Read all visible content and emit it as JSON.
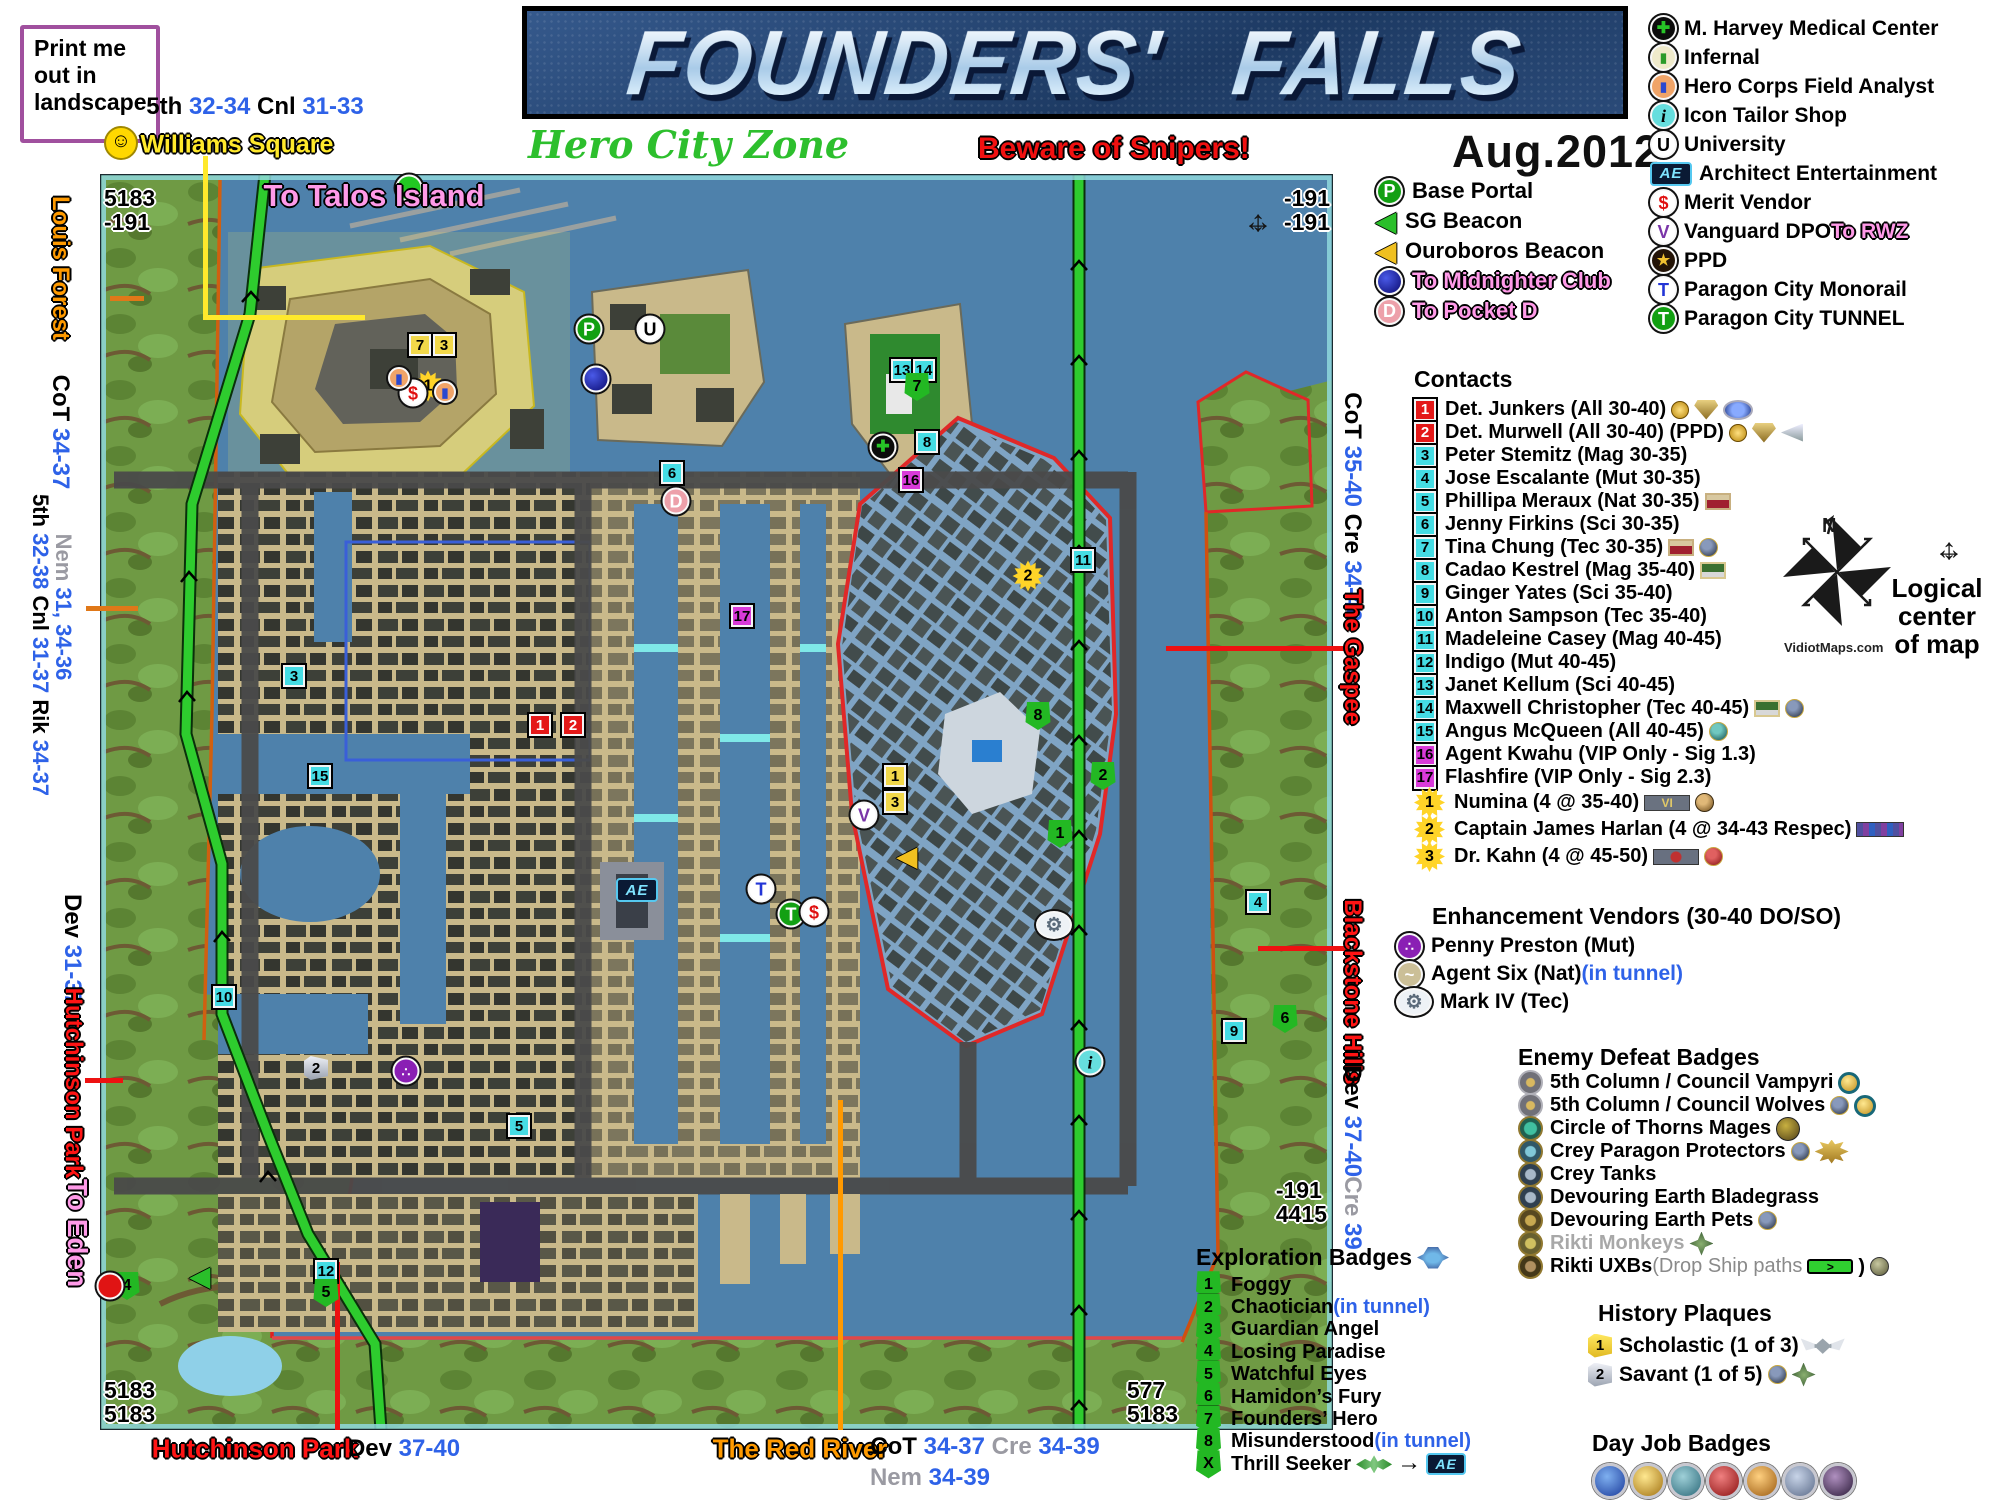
{
  "meta": {
    "title": "FOUNDERS'  FALLS",
    "subtitle": "Hero City Zone",
    "warning": "Beware of Snipers!",
    "date": "Aug.2012",
    "print_note": [
      "Print me",
      "out in",
      "landscape"
    ],
    "smiley_icon": "☺",
    "watermark": "VidiotMaps.com",
    "north_letter": "N",
    "logical_center": [
      "Logical",
      "center",
      "of map"
    ]
  },
  "poi_legend": [
    {
      "t": "hosp",
      "label": "M. Harvey Medical Center"
    },
    {
      "t": "infernal",
      "label": "Infernal"
    },
    {
      "t": "analyst",
      "label": "Hero Corps Field Analyst"
    },
    {
      "t": "i",
      "label": "Icon Tailor Shop"
    },
    {
      "t": "U",
      "label": "University"
    },
    {
      "t": "ae",
      "label": "Architect Entertainment"
    },
    {
      "t": "S",
      "label": "Merit Vendor"
    },
    {
      "t": "V",
      "label": "Vanguard DPO",
      "suffix": [
        [
          " To RWZ",
          "p"
        ]
      ]
    },
    {
      "t": "ppd",
      "label": "PPD"
    },
    {
      "t": "Tm",
      "label": "Paragon City Monorail"
    },
    {
      "t": "Tt",
      "label": "Paragon City TUNNEL"
    }
  ],
  "transit_legend": [
    {
      "t": "P",
      "segs": [
        [
          "Base Portal",
          "k"
        ]
      ]
    },
    {
      "t": "sgb",
      "segs": [
        [
          "SG Beacon",
          "k"
        ]
      ]
    },
    {
      "t": "ouro",
      "segs": [
        [
          "Ouroboros Beacon",
          "k"
        ]
      ]
    },
    {
      "t": "mid",
      "segs": [
        [
          "To Midnighter Club",
          "p"
        ]
      ]
    },
    {
      "t": "D",
      "segs": [
        [
          "To Pocket D",
          "p"
        ]
      ]
    }
  ],
  "contacts": {
    "heading": "Contacts",
    "items": [
      {
        "b": "rbox",
        "n": "1",
        "name": "Det. Junkers (All 30-40)",
        "badges": [
          "medal-gold",
          "shield-wing",
          "disc-bluewing"
        ]
      },
      {
        "b": "rbox",
        "n": "2",
        "name": "Det. Murwell (All 30-40) (PPD)",
        "badges": [
          "medal-gold",
          "shield-wing",
          "wing-silver"
        ]
      },
      {
        "b": "cbox",
        "n": "3",
        "name": "Peter Stemitz (Mag 30-35)"
      },
      {
        "b": "cbox",
        "n": "4",
        "name": "Jose Escalante (Mut 30-35)"
      },
      {
        "b": "cbox",
        "n": "5",
        "name": "Phillipa Meraux (Nat 30-35)",
        "badges": [
          "plaque-red"
        ]
      },
      {
        "b": "cbox",
        "n": "6",
        "name": "Jenny Firkins (Sci 30-35)"
      },
      {
        "b": "cbox",
        "n": "7",
        "name": "Tina Chung (Tec 30-35)",
        "badges": [
          "plaque-red",
          "disc-dark"
        ]
      },
      {
        "b": "cbox",
        "n": "8",
        "name": "Cadao Kestrel (Mag 35-40)",
        "badges": [
          "plaque-green"
        ]
      },
      {
        "b": "cbox",
        "n": "9",
        "name": "Ginger Yates (Sci 35-40)"
      },
      {
        "b": "cbox",
        "n": "10",
        "name": "Anton Sampson (Tec 35-40)"
      },
      {
        "b": "cbox",
        "n": "11",
        "name": "Madeleine Casey (Mag 40-45)"
      },
      {
        "b": "cbox",
        "n": "12",
        "name": "Indigo (Mut 40-45)"
      },
      {
        "b": "cbox",
        "n": "13",
        "name": "Janet Kellum (Sci 40-45)"
      },
      {
        "b": "cbox",
        "n": "14",
        "name": "Maxwell Christopher (Tec 40-45)",
        "badges": [
          "plaque-green",
          "disc-dark"
        ]
      },
      {
        "b": "cbox",
        "n": "15",
        "name": "Angus McQueen (All 40-45)",
        "badges": [
          "disc-teal"
        ]
      },
      {
        "b": "mbox",
        "n": "16",
        "name": "Agent Kwahu (VIP Only - Sig 1.3)"
      },
      {
        "b": "mbox",
        "n": "17",
        "name": "Flashfire (VIP Only - Sig 2.3)"
      },
      {
        "b": "sun",
        "n": "1",
        "name": "Numina (4 @ 35-40)",
        "badges": [
          "bar-vi",
          "disc-laurel"
        ]
      },
      {
        "b": "sun",
        "n": "2",
        "name": "Captain James Harlan (4 @ 34-43 Respec)",
        "badges": [
          "bar-respec"
        ]
      },
      {
        "b": "sun",
        "n": "3",
        "name": "Dr. Kahn (4 @ 45-50)",
        "badges": [
          "bar-kahn",
          "disc-red"
        ]
      }
    ]
  },
  "vendors": {
    "heading": "Enhancement Vendors (30-40 DO/SO)",
    "items": [
      {
        "t": "penny",
        "label": "Penny Preston (Mut)"
      },
      {
        "t": "agentsix",
        "label": "Agent Six (Nat)",
        "suffix": [
          [
            " (in tunnel)",
            "bl"
          ]
        ]
      },
      {
        "t": "gear",
        "label": "Mark IV (Tec)"
      }
    ]
  },
  "enemy_badges": {
    "heading": "Enemy Defeat Badges",
    "items": [
      {
        "t": "d-van",
        "label": "5th Column / Council Vampyri",
        "badges": [
          "btn-gold"
        ]
      },
      {
        "t": "d-van",
        "label": "5th Column / Council Wolves",
        "badges": [
          "disc-dark",
          "btn-gold"
        ]
      },
      {
        "t": "d-cot",
        "label": "Circle of Thorns Mages",
        "badges": [
          "disc-cotlg"
        ]
      },
      {
        "t": "d-crey",
        "label": "Crey Paragon Protectors",
        "badges": [
          "disc-dark",
          "badge-pp"
        ]
      },
      {
        "t": "d-tank",
        "label": "Crey Tanks"
      },
      {
        "t": "d-tank",
        "label": "Devouring Earth Bladegrass"
      },
      {
        "t": "d-de",
        "label": "Devouring Earth Pets",
        "badges": [
          "disc-dark"
        ]
      },
      {
        "t": "d-rik",
        "label": "Rikti Monkeys",
        "gray": true,
        "badges": [
          "badge-sword"
        ]
      },
      {
        "t": "d-uxb",
        "label": "Rikti UXBs",
        "suffix": [
          [
            " (Drop Ship paths ",
            "gd"
          ]
        ],
        "badges": [
          "bar-green",
          "paren",
          "disc-rikti2"
        ]
      }
    ]
  },
  "exploration": {
    "heading": "Exploration Badges",
    "items": [
      {
        "n": "1",
        "label": "Foggy"
      },
      {
        "n": "2",
        "label": "Chaotician",
        "suffix": [
          [
            " (in tunnel)",
            "bl"
          ]
        ]
      },
      {
        "n": "3",
        "label": "Guardian Angel"
      },
      {
        "n": "4",
        "label": "Losing Paradise"
      },
      {
        "n": "5",
        "label": "Watchful Eyes"
      },
      {
        "n": "6",
        "label": "Hamidon’s Fury"
      },
      {
        "n": "7",
        "label": "Founders’ Hero"
      },
      {
        "n": "8",
        "label": "Misunderstood",
        "suffix": [
          [
            " (in tunnel)",
            "bl"
          ]
        ]
      },
      {
        "n": "X",
        "label": "Thrill Seeker",
        "badges": [
          "disc-greenwing",
          "arrow",
          "ae-mini"
        ]
      }
    ]
  },
  "history": {
    "heading": "History Plaques",
    "items": [
      {
        "n": "1",
        "s": "hp1",
        "label": "Scholastic (1 of 3)",
        "badges": [
          "wings-silver"
        ]
      },
      {
        "n": "2",
        "s": "hp2",
        "label": "Savant (1 of 5)",
        "badges": [
          "disc-dark",
          "badge-sword"
        ]
      }
    ]
  },
  "dayjobs": {
    "heading": "Day Job Badges",
    "badges": [
      "dj-blue",
      "dj-gold",
      "dj-teal",
      "dj-red",
      "dj-amber",
      "dj-slate",
      "dj-dark"
    ]
  },
  "edge_labels": [
    {
      "x": 60,
      "y": 268,
      "r": 90,
      "fs": 24,
      "segs": [
        [
          "Louis Forest",
          "o"
        ]
      ]
    },
    {
      "x": 60,
      "y": 432,
      "r": 90,
      "fs": 24,
      "segs": [
        [
          "CoT ",
          "k"
        ],
        [
          "34-37",
          "b"
        ]
      ]
    },
    {
      "x": 40,
      "y": 645,
      "r": 90,
      "fs": 22,
      "segs": [
        [
          "5th ",
          "k"
        ],
        [
          "32-38",
          "b"
        ],
        [
          "  Cnl ",
          "k"
        ],
        [
          "31-37",
          "b"
        ],
        [
          "  Rik ",
          "k"
        ],
        [
          "34-37",
          "b"
        ]
      ]
    },
    {
      "x": 63,
      "y": 607,
      "r": 90,
      "fs": 22,
      "segs": [
        [
          "Nem ",
          "g"
        ],
        [
          "31, 34-36",
          "b"
        ]
      ]
    },
    {
      "x": 72,
      "y": 950,
      "r": 90,
      "fs": 24,
      "segs": [
        [
          "Dev ",
          "k"
        ],
        [
          "31-37",
          "b"
        ]
      ]
    },
    {
      "x": 73,
      "y": 1083,
      "r": 90,
      "fs": 24,
      "segs": [
        [
          "Hutchinson Park",
          "r"
        ]
      ]
    },
    {
      "x": 77,
      "y": 1233,
      "r": 90,
      "fs": 28,
      "segs": [
        [
          "To Eden",
          "p"
        ]
      ]
    },
    {
      "x": 1352,
      "y": 507,
      "r": 90,
      "fs": 24,
      "segs": [
        [
          "CoT ",
          "k"
        ],
        [
          "35-40",
          "b"
        ],
        [
          "  Cre ",
          "k"
        ],
        [
          "34-40",
          "b"
        ]
      ]
    },
    {
      "x": 1352,
      "y": 657,
      "r": 90,
      "fs": 24,
      "segs": [
        [
          "The Gaspee",
          "r"
        ]
      ]
    },
    {
      "x": 1352,
      "y": 992,
      "r": 90,
      "fs": 24,
      "segs": [
        [
          "Blackstone Hills",
          "r"
        ]
      ]
    },
    {
      "x": 1352,
      "y": 1121,
      "r": 90,
      "fs": 24,
      "segs": [
        [
          "Dev ",
          "k"
        ],
        [
          "37-40",
          "b"
        ]
      ]
    },
    {
      "x": 1352,
      "y": 1213,
      "r": 90,
      "fs": 24,
      "segs": [
        [
          "Cre ",
          "g"
        ],
        [
          "39",
          "b"
        ]
      ]
    },
    {
      "x": 255,
      "y": 1449,
      "r": 0,
      "fs": 26,
      "segs": [
        [
          "Hutchinson Park",
          "r"
        ]
      ]
    },
    {
      "x": 404,
      "y": 1449,
      "r": 0,
      "fs": 24,
      "segs": [
        [
          "Dev ",
          "k"
        ],
        [
          "37-40",
          "b"
        ]
      ]
    },
    {
      "x": 800,
      "y": 1449,
      "r": 0,
      "fs": 26,
      "segs": [
        [
          "The Red River",
          "o"
        ]
      ]
    },
    {
      "x": 985,
      "y": 1447,
      "r": 0,
      "fs": 24,
      "segs": [
        [
          "CoT ",
          "k"
        ],
        [
          "34-37",
          "b"
        ],
        [
          "  Cre ",
          "g"
        ],
        [
          "34-39",
          "b"
        ]
      ]
    },
    {
      "x": 930,
      "y": 1478,
      "r": 0,
      "fs": 24,
      "segs": [
        [
          "Nem ",
          "g"
        ],
        [
          "34-39",
          "b"
        ]
      ]
    },
    {
      "x": 255,
      "y": 107,
      "r": 0,
      "fs": 24,
      "segs": [
        [
          "5th ",
          "k"
        ],
        [
          "32-34",
          "b"
        ],
        [
          "  Cnl ",
          "k"
        ],
        [
          "31-33",
          "b"
        ]
      ]
    },
    {
      "x": 237,
      "y": 145,
      "r": 0,
      "fs": 25,
      "segs": [
        [
          "Williams Square",
          "y"
        ]
      ]
    },
    {
      "x": 374,
      "y": 196,
      "r": 0,
      "fs": 31,
      "segs": [
        [
          "To Talos Island",
          "p"
        ]
      ]
    }
  ],
  "map": {
    "corner_coords": [
      {
        "x": 104,
        "y": 186,
        "a": "l",
        "lines": [
          "5183",
          "-191"
        ]
      },
      {
        "x": 1330,
        "y": 186,
        "a": "r",
        "lines": [
          "-191",
          "-191"
        ]
      },
      {
        "x": 104,
        "y": 1378,
        "a": "l",
        "lines": [
          "5183",
          "5183"
        ]
      },
      {
        "x": 1178,
        "y": 1378,
        "a": "r",
        "lines": [
          "577",
          "5183"
        ]
      },
      {
        "x": 1327,
        "y": 1178,
        "a": "r",
        "lines": [
          "-191",
          "4415"
        ]
      }
    ],
    "pointers": [
      {
        "x": 203,
        "y": 156,
        "w": 5,
        "h": 163,
        "c": "#ffe92c"
      },
      {
        "x": 203,
        "y": 315,
        "w": 162,
        "h": 5,
        "c": "#ffe92c"
      },
      {
        "x": 335,
        "y": 1262,
        "w": 5,
        "h": 168,
        "c": "#ee1111"
      },
      {
        "x": 838,
        "y": 1100,
        "w": 5,
        "h": 330,
        "c": "#ff9900"
      },
      {
        "x": 1166,
        "y": 646,
        "w": 180,
        "h": 5,
        "c": "#ee1111"
      },
      {
        "x": 1258,
        "y": 946,
        "w": 88,
        "h": 5,
        "c": "#ee1111"
      },
      {
        "x": 85,
        "y": 1078,
        "w": 38,
        "h": 5,
        "c": "#ee1111"
      },
      {
        "x": 110,
        "y": 296,
        "w": 34,
        "h": 5,
        "c": "#e07818"
      },
      {
        "x": 86,
        "y": 606,
        "w": 52,
        "h": 5,
        "c": "#e07818"
      }
    ],
    "markers": [
      {
        "t": "cbox",
        "n": "3",
        "x": 294,
        "y": 676
      },
      {
        "t": "cbox",
        "n": "6",
        "x": 672,
        "y": 473
      },
      {
        "t": "cbox",
        "n": "8",
        "x": 927,
        "y": 442
      },
      {
        "t": "cbox",
        "n": "9",
        "x": 1234,
        "y": 1031
      },
      {
        "t": "cbox",
        "n": "10",
        "x": 224,
        "y": 997
      },
      {
        "t": "cbox",
        "n": "11",
        "x": 1083,
        "y": 560
      },
      {
        "t": "cbox",
        "n": "4",
        "x": 1258,
        "y": 902
      },
      {
        "t": "cbox",
        "n": "5",
        "x": 519,
        "y": 1126
      },
      {
        "t": "cbox",
        "n": "12",
        "x": 326,
        "y": 1271
      },
      {
        "t": "cbox",
        "n": "15",
        "x": 320,
        "y": 776
      },
      {
        "t": "cbox",
        "n": "13",
        "x": 902,
        "y": 370
      },
      {
        "t": "cbox",
        "n": "14",
        "x": 924,
        "y": 370
      },
      {
        "t": "rbox",
        "n": "1",
        "x": 540,
        "y": 725
      },
      {
        "t": "rbox",
        "n": "2",
        "x": 573,
        "y": 725
      },
      {
        "t": "mbox",
        "n": "16",
        "x": 911,
        "y": 480
      },
      {
        "t": "mbox",
        "n": "17",
        "x": 742,
        "y": 616
      },
      {
        "t": "ybox",
        "n": "7",
        "x": 420,
        "y": 345
      },
      {
        "t": "ybox",
        "n": "3",
        "x": 444,
        "y": 345
      },
      {
        "t": "ybox",
        "n": "1",
        "x": 895,
        "y": 776
      },
      {
        "t": "ybox",
        "n": "3",
        "x": 895,
        "y": 802
      },
      {
        "t": "plq2",
        "n": "2",
        "x": 316,
        "y": 1068
      },
      {
        "t": "shield",
        "n": "7",
        "x": 917,
        "y": 387
      },
      {
        "t": "shield",
        "n": "8",
        "x": 1038,
        "y": 716
      },
      {
        "t": "shield",
        "n": "2",
        "x": 1103,
        "y": 776
      },
      {
        "t": "shield",
        "n": "1",
        "x": 1060,
        "y": 834
      },
      {
        "t": "shield",
        "n": "6",
        "x": 1285,
        "y": 1019
      },
      {
        "t": "shield",
        "n": "5",
        "x": 326,
        "y": 1293
      },
      {
        "t": "shield",
        "n": "4",
        "x": 127,
        "y": 1286
      },
      {
        "t": "sun",
        "n": "1",
        "x": 428,
        "y": 386
      },
      {
        "t": "sun",
        "n": "2",
        "x": 1028,
        "y": 576
      },
      {
        "t": "talos",
        "x": 409,
        "y": 188
      },
      {
        "t": "P",
        "x": 589,
        "y": 329
      },
      {
        "t": "U",
        "x": 650,
        "y": 329
      },
      {
        "t": "mid",
        "x": 596,
        "y": 379
      },
      {
        "t": "hosp",
        "x": 883,
        "y": 447
      },
      {
        "t": "D",
        "x": 676,
        "y": 501
      },
      {
        "t": "V",
        "x": 864,
        "y": 815
      },
      {
        "t": "ouro",
        "x": 907,
        "y": 856
      },
      {
        "t": "sgb",
        "x": 200,
        "y": 1276
      },
      {
        "t": "Tm",
        "x": 761,
        "y": 889
      },
      {
        "t": "Tt",
        "x": 791,
        "y": 914
      },
      {
        "t": "S",
        "x": 814,
        "y": 912
      },
      {
        "t": "S",
        "x": 413,
        "y": 393
      },
      {
        "t": "analyst",
        "x": 399,
        "y": 378
      },
      {
        "t": "analyst",
        "x": 445,
        "y": 392
      },
      {
        "t": "gear",
        "x": 1054,
        "y": 925
      },
      {
        "t": "penny",
        "x": 406,
        "y": 1071
      },
      {
        "t": "i",
        "x": 1090,
        "y": 1062
      },
      {
        "t": "eden",
        "x": 110,
        "y": 1286
      },
      {
        "t": "ae",
        "x": 637,
        "y": 890
      },
      {
        "t": "cross4",
        "x": 1258,
        "y": 222
      }
    ]
  }
}
